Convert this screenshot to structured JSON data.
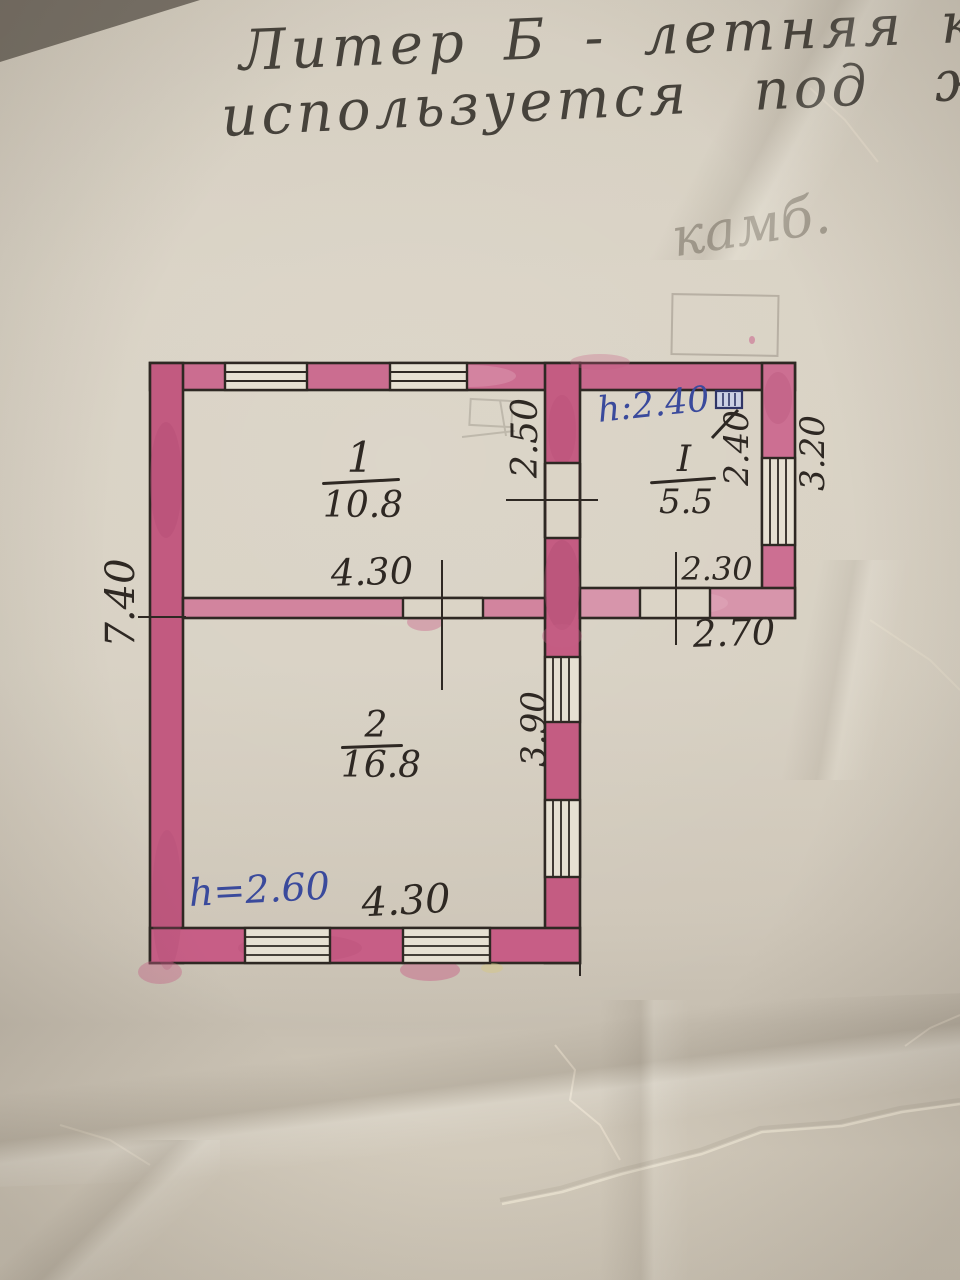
{
  "photo": {
    "handwritten_title": {
      "line1": "Литер Б - летняя кух",
      "line2": "используется под жи"
    },
    "pencil_note": "камб."
  },
  "plan": {
    "overall_depth_m": "7.40",
    "rooms": [
      {
        "number": "1",
        "area_m2": "10.8",
        "width_m": "4.30",
        "depth_m": "2.50"
      },
      {
        "number": "2",
        "area_m2": "16.8",
        "width_m": "4.30",
        "depth_m": "3.90",
        "ceiling_h": "h=2.60"
      },
      {
        "number": "I",
        "area_m2": "5.5",
        "width_m": "2.30",
        "depth_m": "2.40",
        "ceiling_h": "h:2.40",
        "ext_width_m": "2.70",
        "ext_depth_m": "3.20"
      }
    ]
  },
  "colors": {
    "paper": "#d7d0c2",
    "wall_pink": "#c9638a",
    "ink_black": "#2e2823",
    "ink_blue": "#3a4a9c",
    "pencil_grey": "#867f72"
  }
}
